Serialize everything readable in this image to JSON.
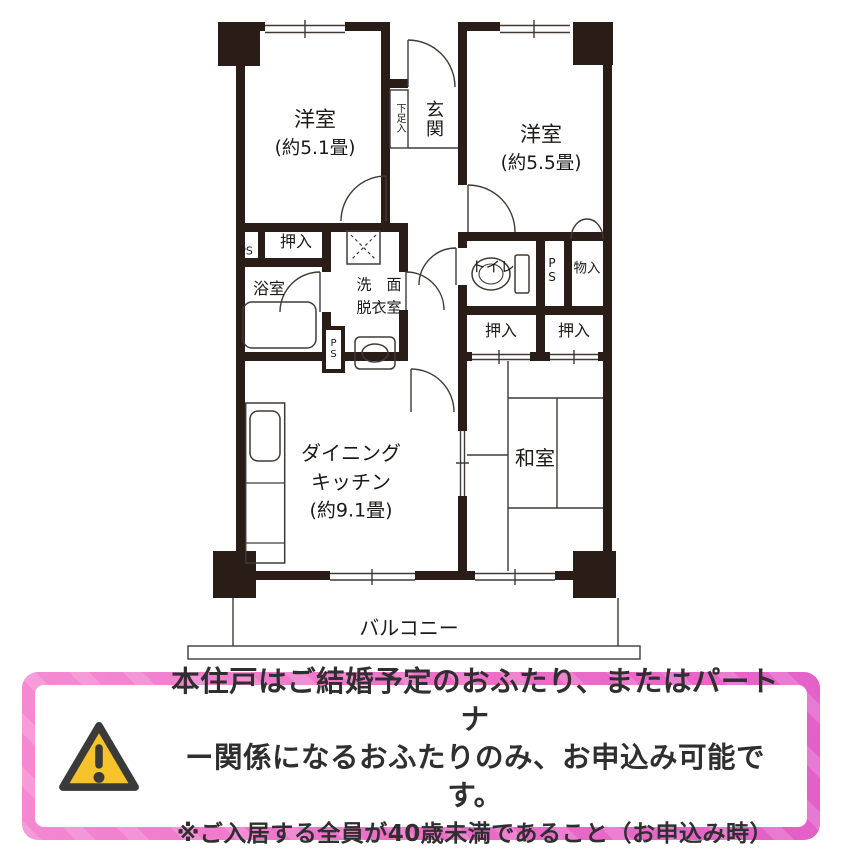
{
  "floorplan": {
    "rooms": {
      "yoshitsu1_name": "洋室",
      "yoshitsu1_size": "(約5.1畳)",
      "yoshitsu2_name": "洋室",
      "yoshitsu2_size": "(約5.5畳)",
      "genkan": "玄関",
      "getabako": "下足入",
      "ps_top": "PS",
      "oshiire_left": "押入",
      "bathroom": "浴室",
      "senmen_line1": "洗　面",
      "senmen_line2": "脱衣室",
      "ps_mid": "PS",
      "toilet": "トイレ",
      "ps_right": "PS",
      "mononyu": "物入",
      "oshiire_right1": "押入",
      "oshiire_right2": "押入",
      "dk_line1": "ダイニング",
      "dk_line2": "キッチン",
      "dk_line3": "(約9.1畳)",
      "washitsu": "和室",
      "balcony": "バルコニー"
    },
    "colors": {
      "wall": "#2a1d18",
      "line": "#403a36"
    }
  },
  "notice": {
    "line1": "本住戸はご結婚予定のおふたり、またはパートナ",
    "line2": "ー関係になるおふたりのみ、お申込み可能です。",
    "line3": "※ご入居する全員が40歳未満であること（お申込み時）",
    "icon": "warning-triangle-icon",
    "colors": {
      "frame_pink": "#ee7bca",
      "triangle_fill": "#f6c429",
      "triangle_stroke": "#3a3a3a",
      "text": "#2f2f2f"
    }
  }
}
